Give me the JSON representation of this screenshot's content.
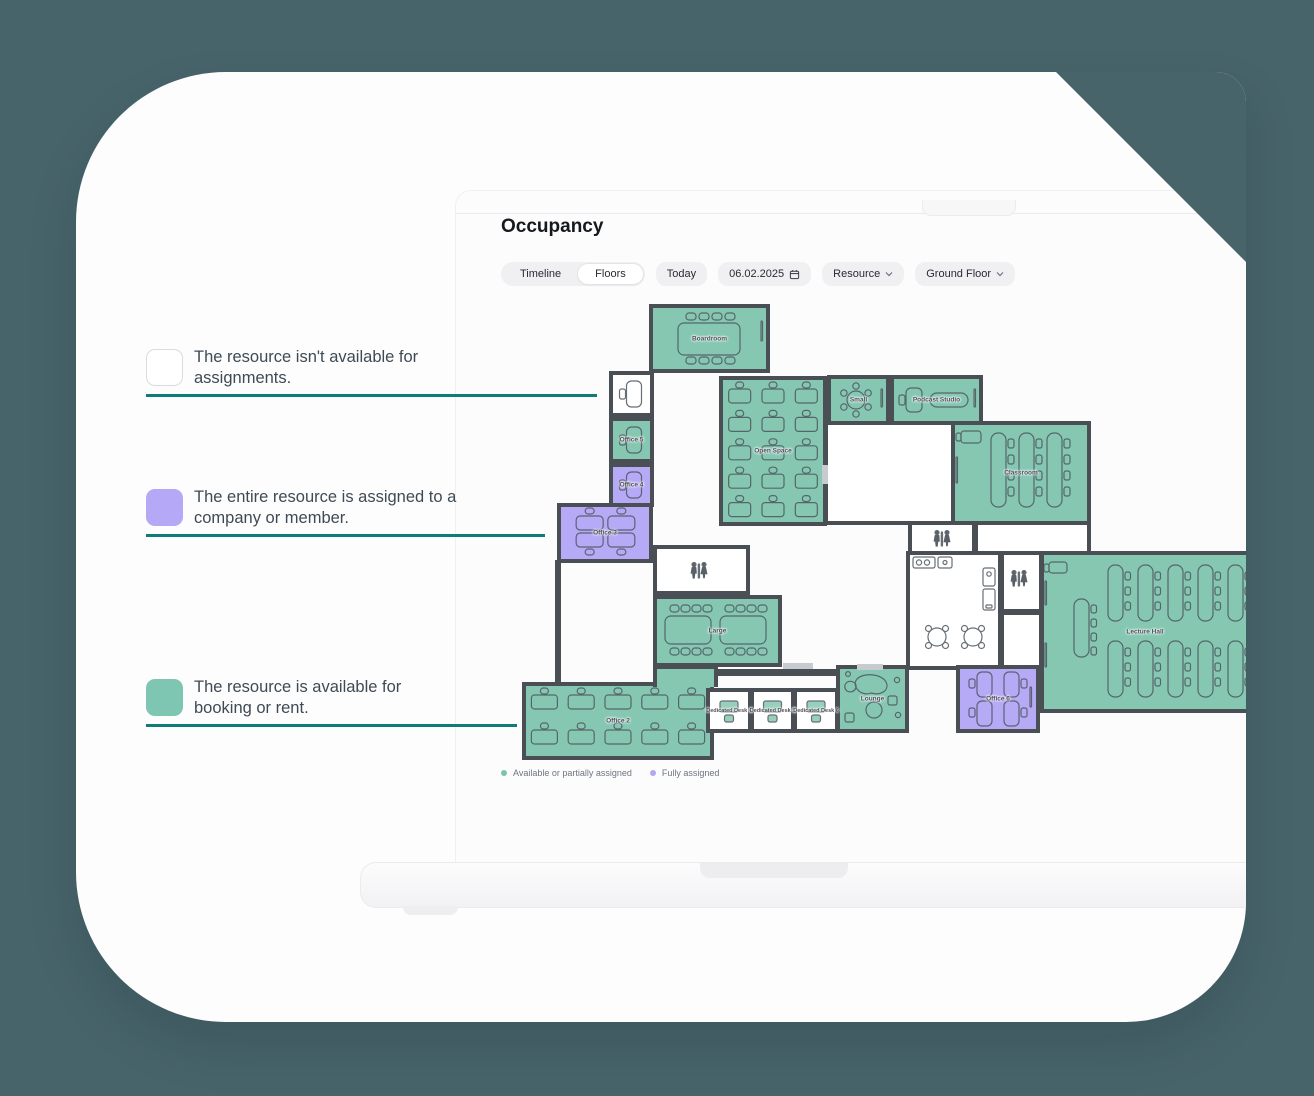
{
  "background_color": "#48646b",
  "annotations": {
    "line_color": "#0e7d79",
    "items": [
      {
        "id": "unavailable",
        "swatch_color": "#ffffff",
        "text": "The resource isn't available for assignments."
      },
      {
        "id": "assigned",
        "swatch_color": "#b5a8f6",
        "text": "The entire resource is assigned to a company or member."
      },
      {
        "id": "available",
        "swatch_color": "#7ec6b1",
        "text": "The resource is available for booking or rent."
      }
    ]
  },
  "app": {
    "title": "Occupancy",
    "toolbar": {
      "tabs": [
        {
          "label": "Timeline",
          "selected": false
        },
        {
          "label": "Floors",
          "selected": true
        }
      ],
      "today_label": "Today",
      "date_value": "06.02.2025",
      "resource_label": "Resource",
      "floor_label": "Ground Floor"
    },
    "legend": [
      {
        "label": "Available or partially assigned",
        "color": "#7cc3ae"
      },
      {
        "label": "Fully assigned",
        "color": "#b3a6f4"
      }
    ]
  },
  "floorplan": {
    "wall_color": "#4a4f56",
    "status_colors": {
      "available": "#86c7b2",
      "assigned": "#b6a9f6",
      "unavailable": "#ffffff"
    },
    "rooms": [
      {
        "id": "boardroom",
        "label": "Boardroom",
        "status": "available",
        "x": 649,
        "y": 304,
        "w": 121,
        "h": 69,
        "furniture": {
          "type": "conf8"
        }
      },
      {
        "id": "room-unavailable",
        "label": "",
        "status": "unavailable",
        "x": 609,
        "y": 371,
        "w": 45,
        "h": 46,
        "furniture": {
          "type": "singleDesk"
        }
      },
      {
        "id": "office-5",
        "label": "Office 5",
        "status": "available",
        "x": 609,
        "y": 417,
        "w": 45,
        "h": 46,
        "furniture": {
          "type": "singleDesk"
        }
      },
      {
        "id": "office-4",
        "label": "Office 4",
        "status": "assigned",
        "x": 609,
        "y": 463,
        "w": 45,
        "h": 44,
        "furniture": {
          "type": "singleDesk"
        }
      },
      {
        "id": "office-3",
        "label": "Office 3",
        "status": "assigned",
        "x": 557,
        "y": 503,
        "w": 96,
        "h": 60,
        "furniture": {
          "type": "desks2x2H"
        }
      },
      {
        "id": "open-space",
        "label": "Open Space",
        "status": "available",
        "x": 719,
        "y": 376,
        "w": 108,
        "h": 150,
        "furniture": {
          "type": "deskGrid",
          "cols": 3,
          "rows": 5,
          "dw": 22
        }
      },
      {
        "id": "small",
        "label": "Small",
        "status": "available",
        "x": 827,
        "y": 375,
        "w": 63,
        "h": 50,
        "furniture": {
          "type": "round6"
        }
      },
      {
        "id": "podcast-studio",
        "label": "Podcast Studio",
        "status": "available",
        "x": 890,
        "y": 375,
        "w": 93,
        "h": 50,
        "furniture": {
          "type": "podcast"
        }
      },
      {
        "id": "hall-mid",
        "label": "",
        "status": "unavailable",
        "x": 824,
        "y": 421,
        "w": 131,
        "h": 104,
        "furniture": {
          "type": "none"
        }
      },
      {
        "id": "classroom",
        "label": "Classroom",
        "status": "available",
        "x": 951,
        "y": 421,
        "w": 140,
        "h": 104,
        "furniture": {
          "type": "classroom"
        }
      },
      {
        "id": "wc-1",
        "label": "",
        "status": "unavailable",
        "x": 908,
        "y": 521,
        "w": 68,
        "h": 34,
        "furniture": {
          "type": "wc",
          "icon": [
            30,
            14
          ]
        }
      },
      {
        "id": "hall-right",
        "label": "",
        "status": "unavailable",
        "x": 974,
        "y": 521,
        "w": 117,
        "h": 34,
        "furniture": {
          "type": "none"
        }
      },
      {
        "id": "kitchen",
        "label": "",
        "status": "unavailable",
        "x": 906,
        "y": 551,
        "w": 96,
        "h": 119,
        "furniture": {
          "type": "kitchen"
        }
      },
      {
        "id": "wc-2",
        "label": "",
        "status": "unavailable",
        "x": 1000,
        "y": 551,
        "w": 43,
        "h": 62,
        "furniture": {
          "type": "wc",
          "icon": [
            15,
            24
          ]
        }
      },
      {
        "id": "hall-2",
        "label": "",
        "status": "unavailable",
        "x": 1000,
        "y": 611,
        "w": 43,
        "h": 59,
        "furniture": {
          "type": "none"
        }
      },
      {
        "id": "lecture-hall",
        "label": "Lecture Hall",
        "status": "available",
        "x": 1040,
        "y": 551,
        "w": 210,
        "h": 162,
        "furniture": {
          "type": "lecture"
        }
      },
      {
        "id": "wc-3",
        "label": "",
        "status": "unavailable",
        "x": 653,
        "y": 545,
        "w": 97,
        "h": 50,
        "furniture": {
          "type": "wc",
          "icon": [
            42,
            22
          ]
        }
      },
      {
        "id": "large",
        "label": "Large",
        "status": "available",
        "x": 653,
        "y": 595,
        "w": 129,
        "h": 72,
        "furniture": {
          "type": "large2"
        }
      },
      {
        "id": "office-2",
        "label": "Office 2",
        "status": "available",
        "x": 522,
        "y": 682,
        "w": 192,
        "h": 78,
        "furniture": {
          "type": "deskGrid",
          "cols": 5,
          "rows": 2,
          "dw": 26
        }
      },
      {
        "id": "stair-link",
        "label": "",
        "status": "available",
        "x": 653,
        "y": 665,
        "w": 65,
        "h": 22,
        "furniture": {
          "type": "none"
        },
        "open_bottom": true
      },
      {
        "id": "lounge",
        "label": "Lounge",
        "status": "available",
        "x": 836,
        "y": 665,
        "w": 73,
        "h": 68,
        "furniture": {
          "type": "lounge"
        }
      },
      {
        "id": "office-6",
        "label": "Office 6",
        "status": "assigned",
        "x": 956,
        "y": 665,
        "w": 84,
        "h": 68,
        "furniture": {
          "type": "desks2x2V"
        }
      },
      {
        "id": "dedicated-desk-4",
        "label": "Dedicated Desk 4",
        "status": "unavailable",
        "x": 706,
        "y": 688,
        "w": 46,
        "h": 45,
        "furniture": {
          "type": "miniDesk"
        }
      },
      {
        "id": "dedicated-desk-5",
        "label": "Dedicated Desk 5",
        "status": "unavailable",
        "x": 750,
        "y": 688,
        "w": 45,
        "h": 45,
        "furniture": {
          "type": "miniDesk"
        }
      },
      {
        "id": "dedicated-desk-6",
        "label": "Dedicated Desk 6",
        "status": "unavailable",
        "x": 793,
        "y": 688,
        "w": 46,
        "h": 45,
        "furniture": {
          "type": "miniDesk"
        }
      }
    ]
  }
}
